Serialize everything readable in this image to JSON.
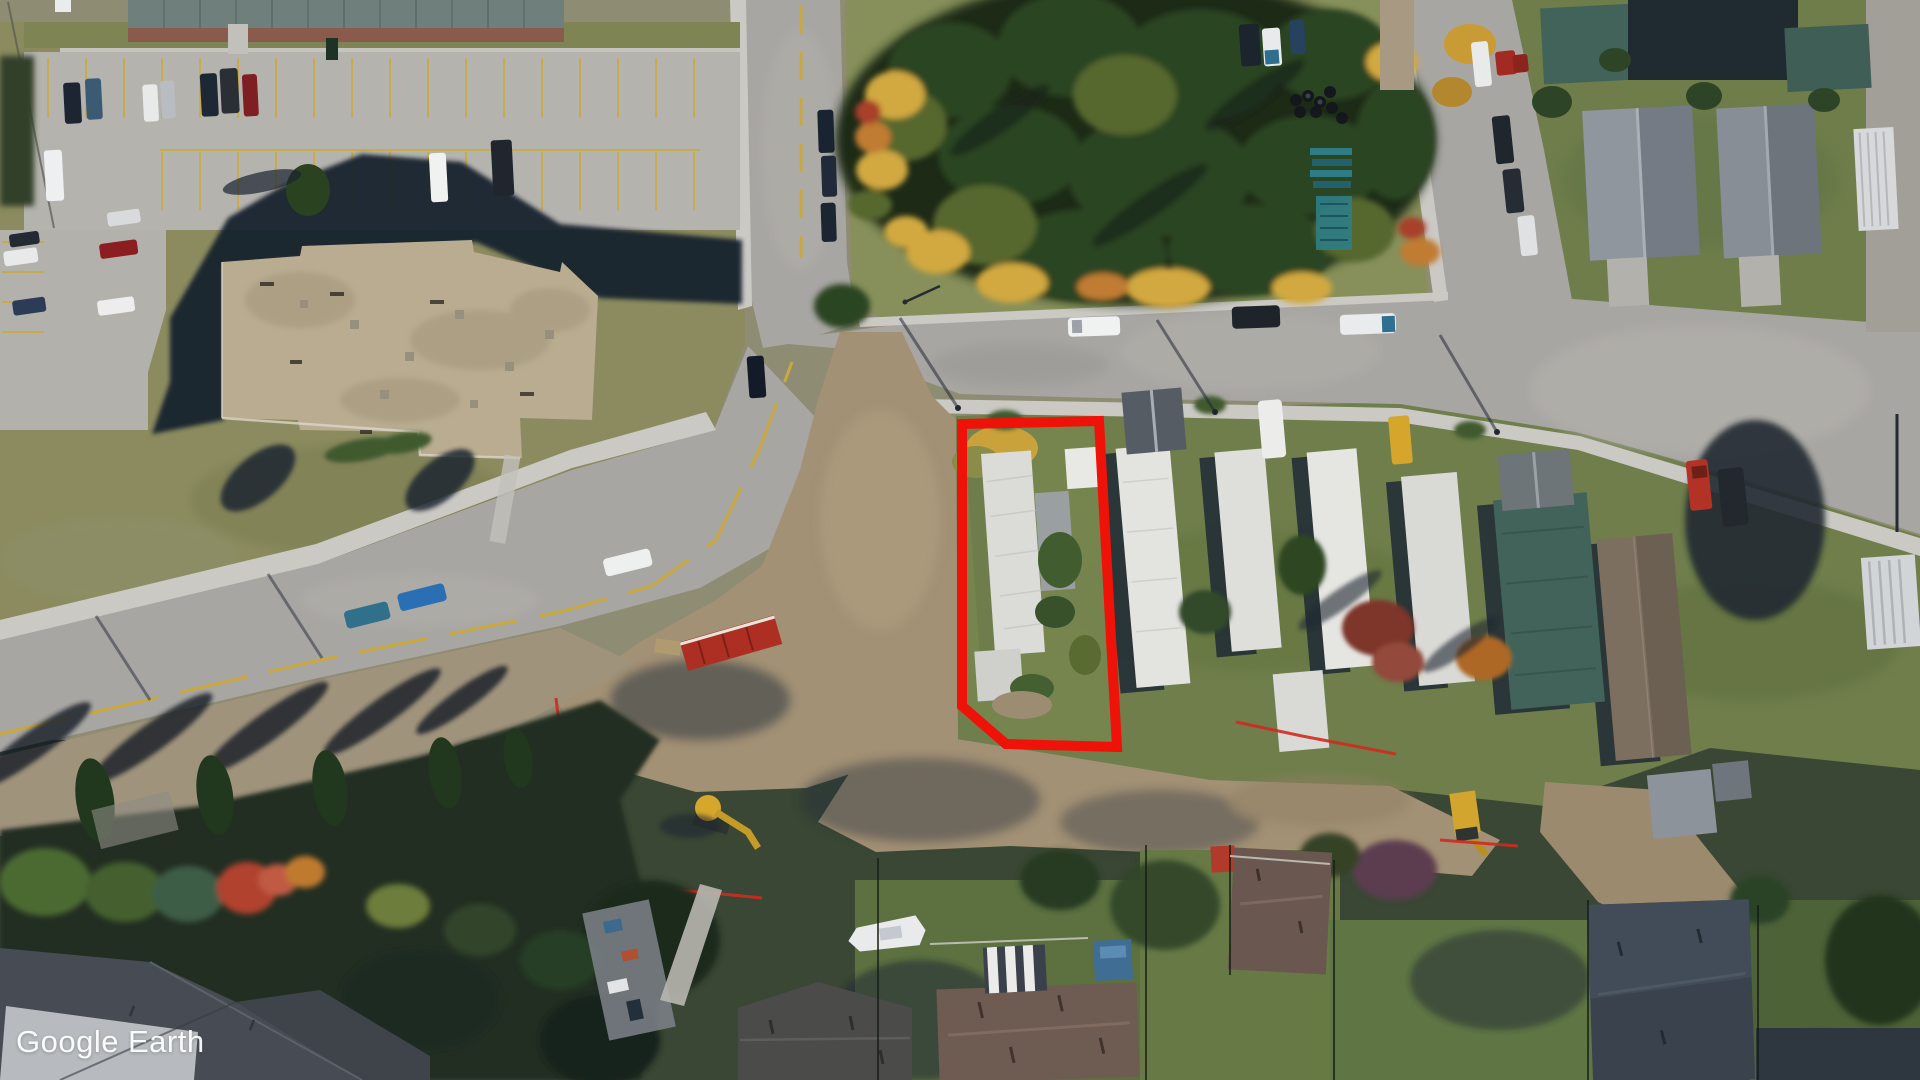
{
  "watermark": {
    "text": "Google Earth",
    "brand": "Google",
    "product": "Earth",
    "color": "#ffffff"
  },
  "annotation": {
    "label": "highlighted property boundary",
    "color": "#ee1208",
    "stroke_width": 10,
    "points": "962,424 1099,421 1117,747 1006,744 962,706"
  },
  "palette": {
    "road": "#a8a6a2",
    "sidewalk": "#cbc9c4",
    "parking": "#b5b3ae",
    "lawn_dry": "#8b8b5f",
    "grass_green": "#6f7e4b",
    "dirt": "#a39175",
    "shadow": "#1b2533",
    "tree_dark": "#2c4522",
    "tree_yellow": "#d2a83f",
    "trailer_roof": "#e0e0dc",
    "teal_roof": "#41635a",
    "brown_roof": "#7d6f60",
    "stall_line_yellow": "#c9a93e"
  }
}
